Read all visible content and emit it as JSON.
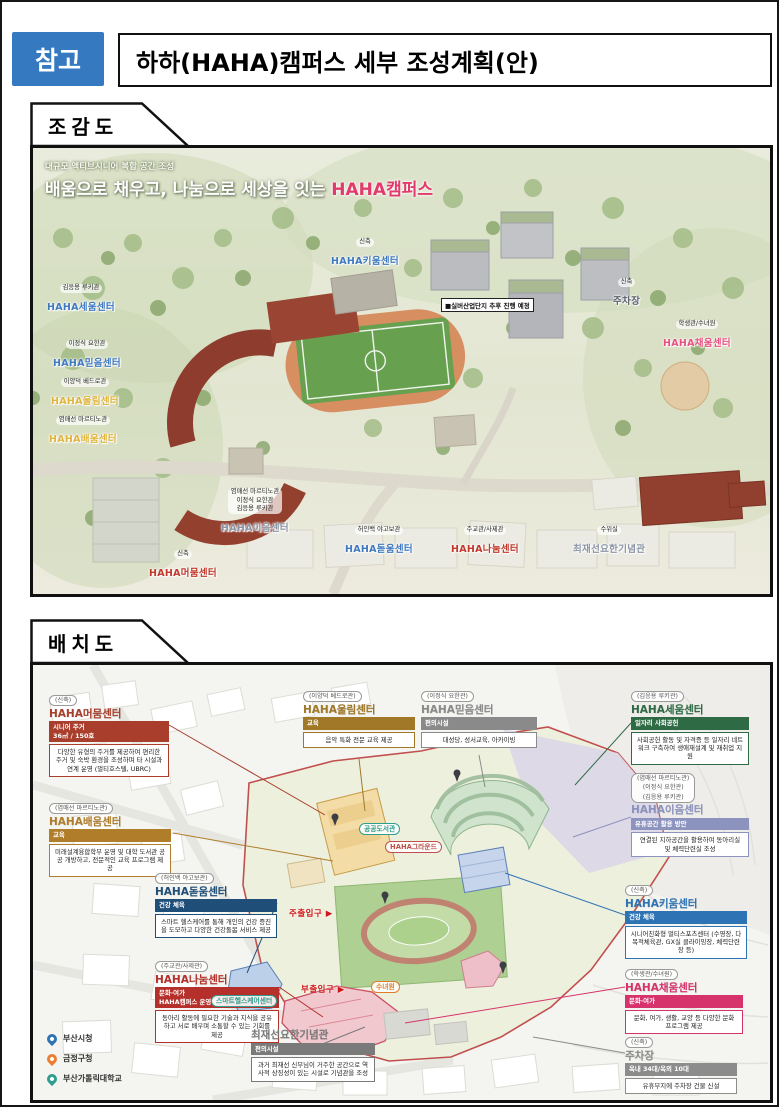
{
  "header": {
    "badge": "참고",
    "title": "하하(HAHA)캠퍼스 세부 조성계획(안)"
  },
  "sections": {
    "aerial_label": "조감도",
    "layout_label": "배치도"
  },
  "aerial": {
    "subtitle": "대규모 액티브시니어 복합 공간 조성",
    "headline_prefix": "배움으로 채우고, 나눔으로 세상을 잇는 ",
    "headline_highlight": "HAHA캠퍼스",
    "note": "■실버산업단지 추후 진행 예정",
    "labels": [
      {
        "tag": "신축",
        "name": "HAHA키움센터",
        "color": "#3f79c0"
      },
      {
        "tag": "김응용 루키관",
        "name": "HAHA세움센터",
        "color": "#3f79c0"
      },
      {
        "tag": "이정식 요한관",
        "name": "HAHA믿음센터",
        "color": "#3f79c0"
      },
      {
        "tag": "이양덕 베드로관",
        "name": "HAHA울림센터",
        "color": "#e0b53e"
      },
      {
        "tag": "염매선 마르티노관",
        "name": "HAHA배움센터",
        "color": "#e0b53e"
      },
      {
        "tag": "신축",
        "name": "주차장",
        "color": "#5a5f6a"
      },
      {
        "tag": "학생관/수녀원",
        "name": "HAHA채움센터",
        "color": "#e8517f"
      },
      {
        "tag": "염매선 마르티노관\n이정식 요한관\n김응용 루키관",
        "name": "HAHA이음센터",
        "color": "#8b95a5"
      },
      {
        "tag": "허인백 야고보관",
        "name": "HAHA돋움센터",
        "color": "#3f79c0"
      },
      {
        "tag": "주교관/사제관",
        "name": "HAHA나눔센터",
        "color": "#c0392b"
      },
      {
        "tag": "수위실",
        "name": "최재선요한기념관",
        "color": "#8b95a5"
      },
      {
        "tag": "신축",
        "name": "HAHA머뭄센터",
        "color": "#c0392b"
      }
    ]
  },
  "layout": {
    "cards": [
      {
        "tag": "(신축)",
        "title": "HAHA머뭄센터",
        "sub": "시니어 주거\n36㎡ / 150호",
        "desc": "다양한 유형의 주거를 제공하여 편리한 주거 및 숙박 환경을 조성하며 타 시설과 연계 운영 (멀티호스텔, UBRC)",
        "color": "#a93e2c"
      },
      {
        "tag": "(염매선 마르티노관)",
        "title": "HAHA배움센터",
        "sub": "교육",
        "desc": "미래설계융합학부 운영 및 대학 도서관 공공 개방하고, 전문적인 교육 프로그램 제공",
        "color": "#b07d2b"
      },
      {
        "tag": "(허인백 야고보관)",
        "title": "HAHA돋움센터",
        "sub": "건강 체육",
        "desc": "스마트 헬스케어를 통해 개인의 건강 증진을 도모하고 다양한 건강돌봄 서비스 제공",
        "color": "#1f4e79"
      },
      {
        "tag": "(주교관/사제관)",
        "title": "HAHA나눔센터",
        "sub": "문화·여가\nHAHA캠퍼스 운영센터",
        "desc": "동아리 활동에 필요한 기술과 지식을 공유하고 서로 배우며 소통할 수 있는 기회를 제공",
        "color": "#b5302a"
      },
      {
        "tag": "(이양덕 베드로관)",
        "title": "HAHA울림센터",
        "sub": "교육",
        "desc": "음악 특화 전문 교육 제공",
        "color": "#a07828"
      },
      {
        "tag": "(이정식 요한관)",
        "title": "HAHA믿음센터",
        "sub": "편의시설",
        "desc": "대성당, 성서교육, 아카이빙",
        "color": "#8a8a8a"
      },
      {
        "tag": "(김응용 루키관)",
        "title": "HAHA세움센터",
        "sub": "일자리 사회공헌",
        "desc": "사회공헌 활동 및 자격증 등 일자리 네트워크 구축하여 생애재설계 및 재취업 지원",
        "color": "#2e6b45"
      },
      {
        "tag": "(염매선 마르티노관)\n(이정식 요한관)\n(김응용 루키관)",
        "title": "HAHA이음센터",
        "sub": "유휴공간 활용 방안",
        "desc": "연결된 지하공간을 활용하여 동아리실 및 체력단련실 조성",
        "color": "#8d93bf"
      },
      {
        "tag": "(신축)",
        "title": "HAHA키움센터",
        "sub": "건강 체육",
        "desc": "시니어친화형 멀티스포츠센터 (수영장, 다목적체육관, GX실 클라이밍장, 체력단련장 등)",
        "color": "#2e74b5"
      },
      {
        "tag": "(학생관/수녀원)",
        "title": "HAHA채움센터",
        "sub": "문화·여가",
        "desc": "문화, 여가, 생활, 교양 등 다양한 문화 프로그램 제공",
        "color": "#d6336c"
      },
      {
        "tag": "(신축)",
        "title": "주차장",
        "sub": "옥내 34대/옥외 10대",
        "desc": "유휴부지에 주차장 건물 신설",
        "color": "#8c8c8c"
      },
      {
        "tag": "",
        "title": "최재선요한기념관",
        "sub": "편의시설",
        "desc": "과거 최재선 신부님이 거주한 공간으로 역사적 상징성이 있는 시설로 기념관을 조성",
        "color": "#7a7a7a"
      }
    ],
    "map_labels": {
      "main_entrance": "주출입구 ▶",
      "sub_entrance": "부출입구 ▶",
      "ground": "HAHA그라운드",
      "library": "공공도서관",
      "smart_health": "스마트헬스케어센터",
      "convent": "수녀원"
    },
    "legend": [
      {
        "label": "부산시청",
        "color": "#2e74b5"
      },
      {
        "label": "금정구청",
        "color": "#ed7d31"
      },
      {
        "label": "부산가톨릭대학교",
        "color": "#2e9e8f"
      }
    ]
  }
}
